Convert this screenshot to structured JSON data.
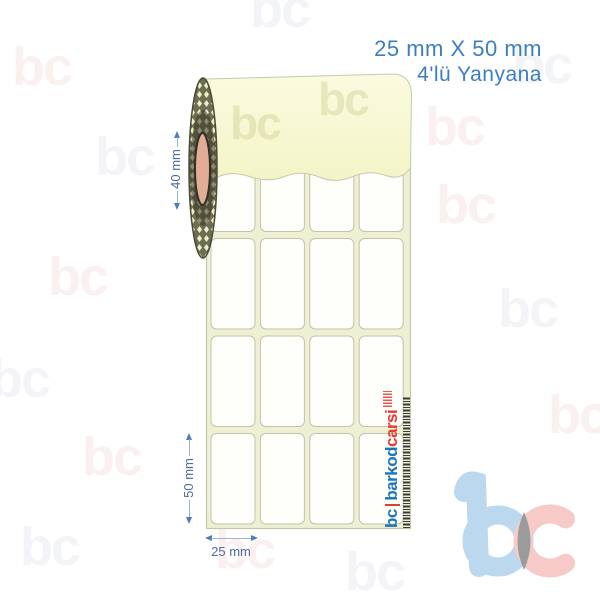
{
  "header": {
    "size_label": "25 mm X 50 mm",
    "layout_label": "4'lü Yanyana"
  },
  "annotations": {
    "core_width": "40 mm",
    "label_height": "50 mm",
    "label_width": "25 mm"
  },
  "grid": {
    "columns": 4,
    "rows": 4
  },
  "brand": {
    "short": "bc",
    "name_blue": "barkod",
    "name_red": "carsi",
    "watermark_text": "bc"
  },
  "colors": {
    "accent_blue": "#3D7EC0",
    "dimension_blue": "#4A6E9E",
    "dimension_arrow": "#4A7EBB",
    "logo_blue": "#1B75BC",
    "logo_red": "#E8392F",
    "roll_surface": "#F7F8CF",
    "liner": "#EFF0D3",
    "label_fill": "#FEFEFB",
    "core_pink": "#E2AC95",
    "coil_dark": "#6E6E52",
    "watermark_blue": "#BCD8EE",
    "watermark_red": "#F6CBC7",
    "watermark_overlap": "#9B9B9B"
  }
}
